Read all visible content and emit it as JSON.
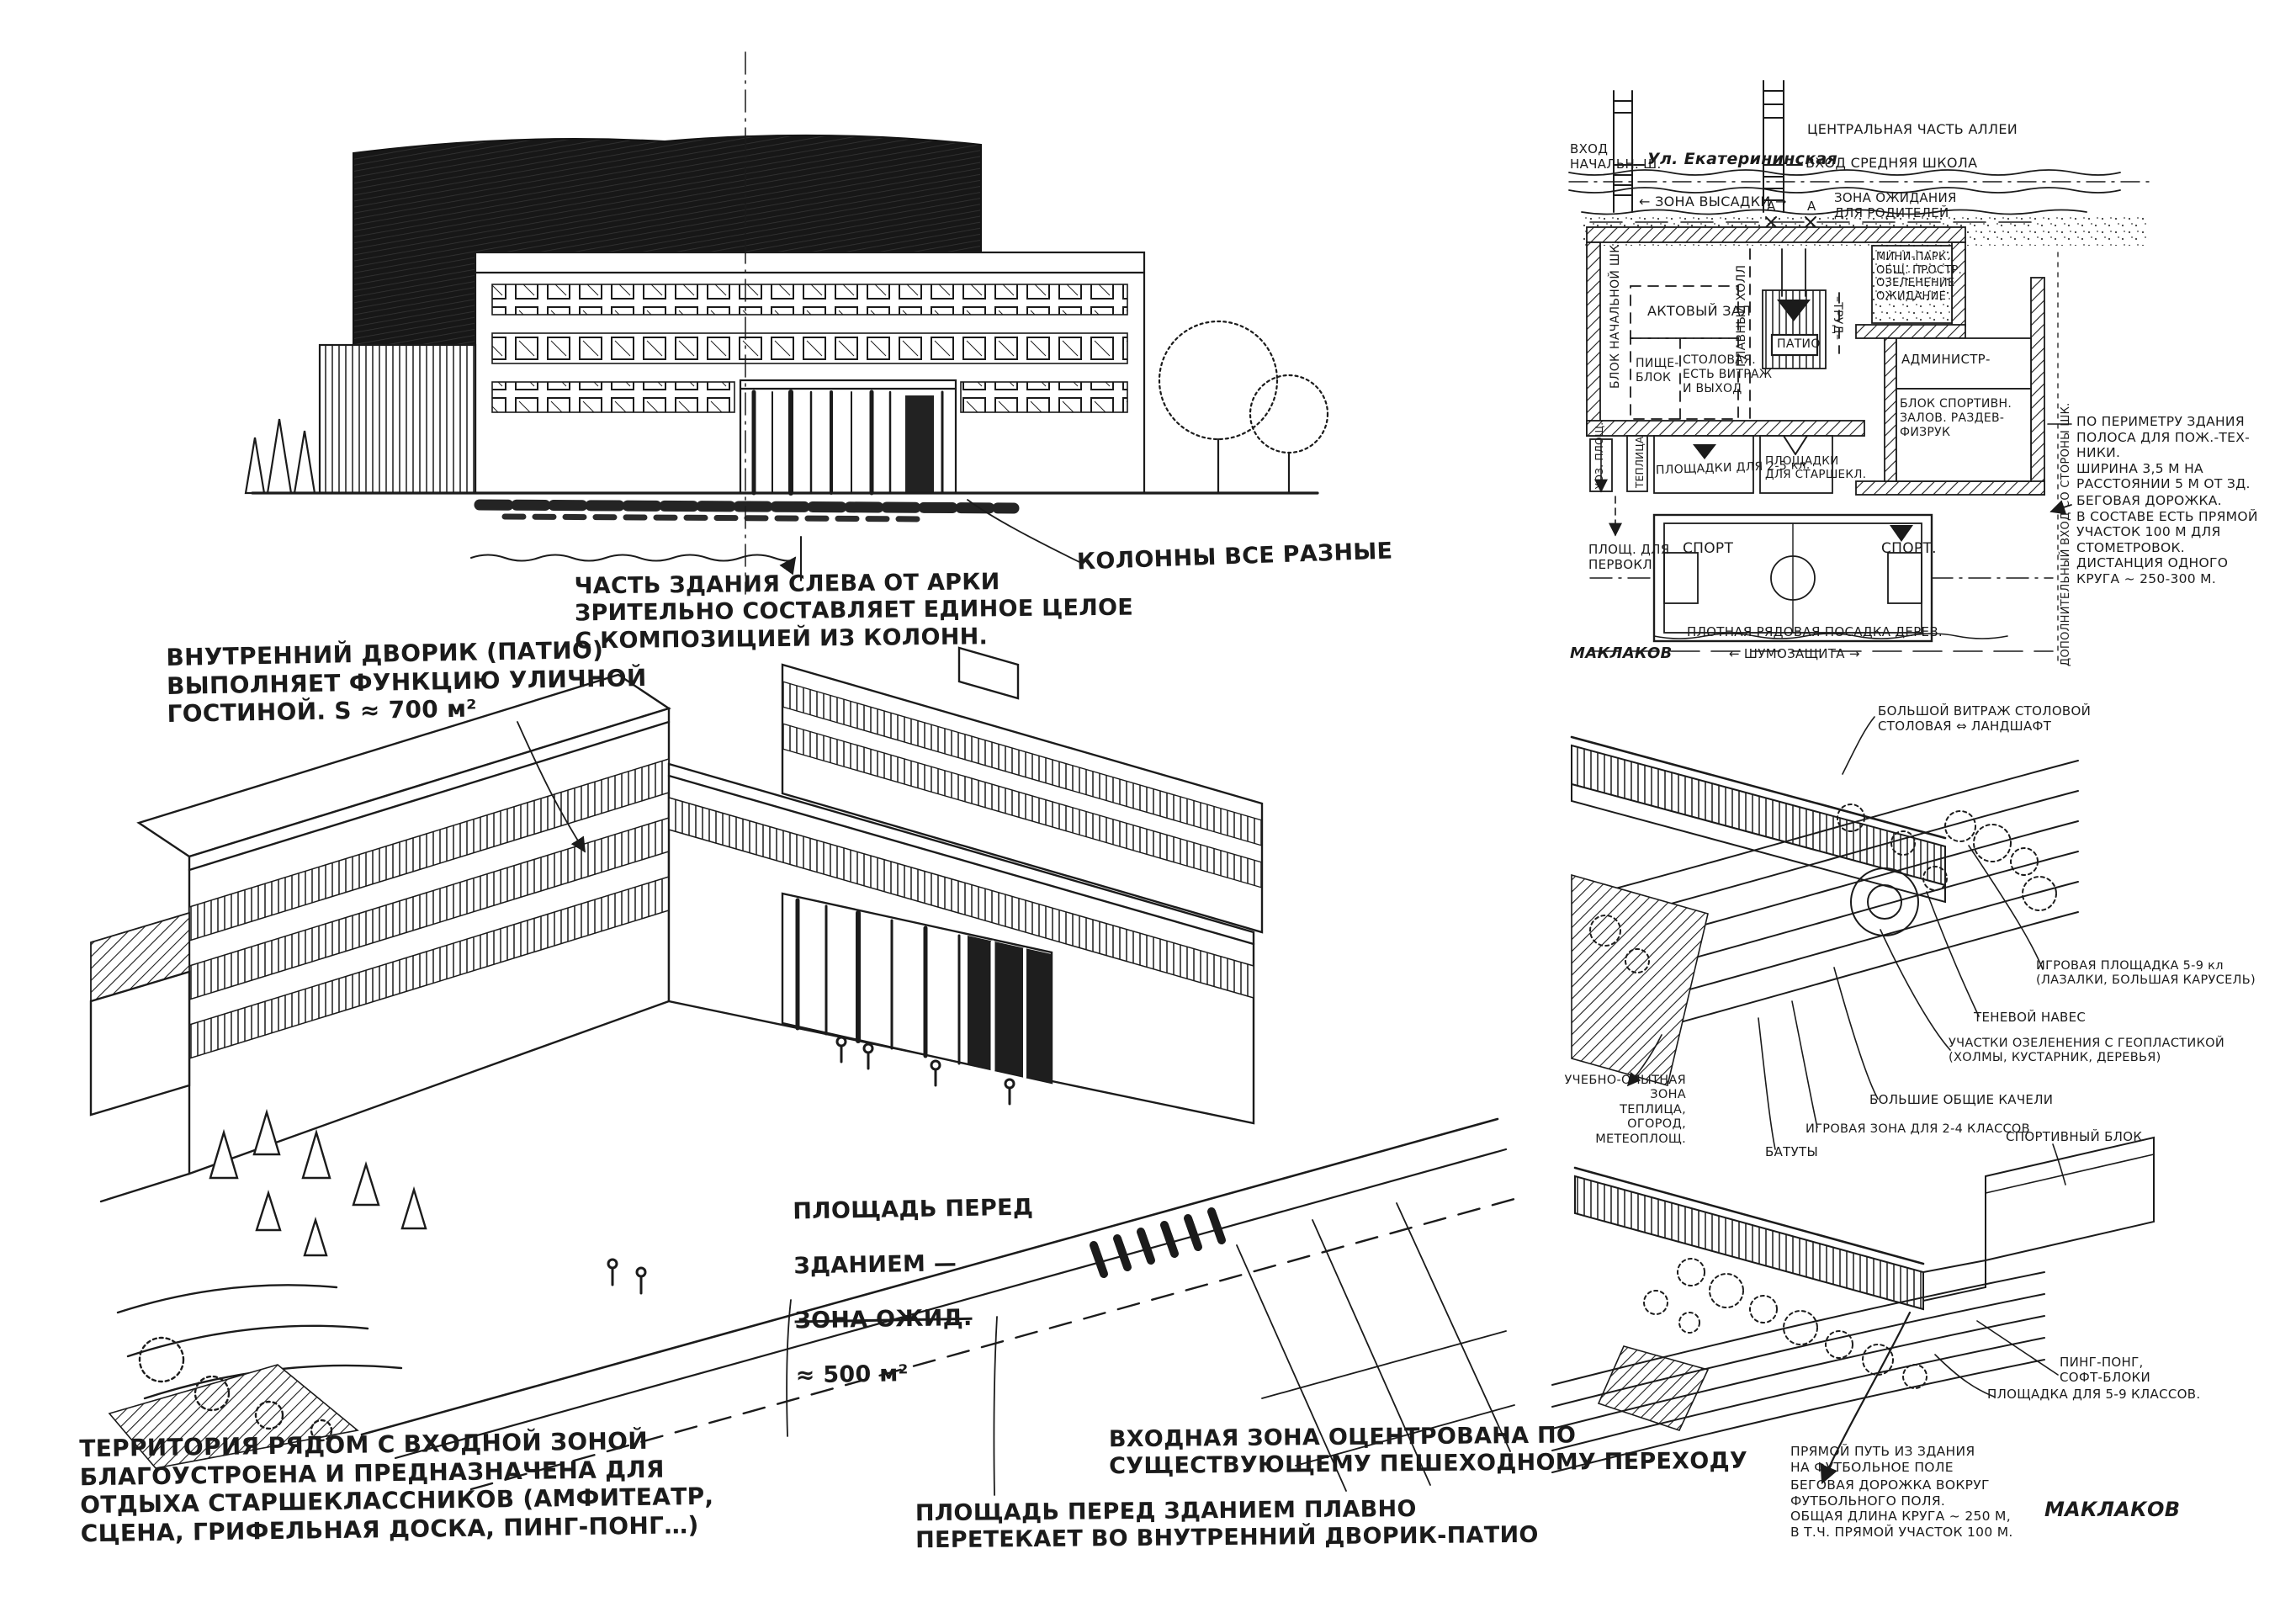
{
  "colors": {
    "ink": "#1b1b1b",
    "paper": "#ffffff"
  },
  "elevation_notes": {
    "composition": {
      "lines": [
        "ЧАСТЬ ЗДАНИЯ СЛЕВА ОТ АРКИ",
        "ЗРИТЕЛЬНО СОСТАВЛЯЕТ ЕДИНОЕ ЦЕЛОЕ",
        "С КОМПОЗИЦИЕЙ ИЗ КОЛОНН."
      ]
    },
    "columns": "КОЛОННЫ ВСЕ РАЗНЫЕ"
  },
  "axon_main_notes": {
    "patio": {
      "lines": [
        "ВНУТРЕННИЙ ДВОРИК (ПАТИО)",
        "ВЫПОЛНЯЕТ ФУНКЦИЮ УЛИЧНОЙ",
        "ГОСТИНОЙ.  S ≈ 700 м²"
      ]
    },
    "plaza": {
      "l1": "ПЛОЩАДЬ ПЕРЕД",
      "l2": "ЗДАНИЕМ —",
      "l3": "ЗОНА ОЖИД.",
      "l4": "≈ 500 м²"
    },
    "territory": {
      "lines": [
        "ТЕРРИТОРИЯ РЯДОМ С ВХОДНОЙ ЗОНОЙ",
        "БЛАГОУСТРОЕНА И ПРЕДНАЗНАЧЕНА ДЛЯ",
        "ОТДЫХА СТАРШЕКЛАССНИКОВ (АМФИТЕАТР,",
        "СЦЕНА, ГРИФЕЛЬНАЯ ДОСКА, ПИНГ-ПОНГ…)"
      ]
    },
    "entrance": {
      "lines": [
        "ВХОДНАЯ ЗОНА ОЦЕНТРОВАНА ПО",
        "СУЩЕСТВУЮЩЕМУ ПЕШЕХОДНОМУ ПЕРЕХОДУ"
      ]
    },
    "flow": {
      "lines": [
        "ПЛОЩАДЬ ПЕРЕД ЗДАНИЕМ ПЛАВНО",
        "ПЕРЕТЕКАЕТ ВО ВНУТРЕННИЙ ДВОРИК-ПАТИО"
      ]
    }
  },
  "site_plan": {
    "street_name": "Ул. Екатерининская",
    "alley": "ЦЕНТРАЛЬНАЯ ЧАСТЬ АЛЛЕИ",
    "entry_primary": {
      "lines": [
        "ВХОД",
        "НАЧАЛЬН. Ш."
      ]
    },
    "entry_secondary": "ВХОД СРЕДНЯЯ ШКОЛА",
    "dropoff_zone": "← ЗОНА ВЫСАДКИ →",
    "marker_a": "А",
    "waiting_zone": {
      "lines": [
        "ЗОНА ОЖИДАНИЯ",
        "ДЛЯ РОДИТЕЛЕЙ"
      ]
    },
    "mini_park": {
      "lines": [
        "МИНИ-ПАРК.",
        "ОБЩ. ПРОСТР.",
        "ОЗЕЛЕНЕНИЕ",
        "ОЖИДАНИЕ"
      ]
    },
    "primary_school_block": "БЛОК НАЧАЛЬНОЙ ШК.",
    "assembly_hall": "АКТОВЫЙ ЗАЛ",
    "food_block": {
      "lines": [
        "ПИЩЕ-",
        "БЛОК"
      ]
    },
    "canteen": {
      "lines": [
        "СТОЛОВАЯ.",
        "ЕСТЬ ВИТРАЖ",
        "И ВЫХОД"
      ]
    },
    "main_hall": "ГЛАВНЫЙ ХОЛЛ",
    "patio": "ПАТИО",
    "trud": "–ТРУД–",
    "admin": "АДМИНИСТР-",
    "sport_halls": {
      "lines": [
        "БЛОК СПОРТИВН.",
        "ЗАЛОВ. РАЗДЕВ-",
        "ФИЗРУК"
      ]
    },
    "hoz": "ХОЗ. ПЛОЩ.",
    "greenhouse": "ТЕПЛИЦА",
    "grounds_2_5": "ПЛОЩАДКИ ДЛЯ 2-5 кл.",
    "grounds_senior": {
      "lines": [
        "ПЛОЩАДКИ",
        "ДЛЯ СТАРШЕКЛ."
      ]
    },
    "grounds_first": {
      "lines": [
        "ПЛОЩ. ДЛЯ",
        "ПЕРВОКЛ."
      ]
    },
    "sport_left": "СПОРТ",
    "sport_right": "СПОРТ.",
    "tree_row": "ПЛОТНАЯ РЯДОВАЯ ПОСАДКА ДЕРЕВ.",
    "noise_shield": "←  ШУМОЗАЩИТА  →",
    "signature": "МАКЛАКОВ",
    "fire_lane_note": {
      "lines": [
        "ПО ПЕРИМЕТРУ ЗДАНИЯ",
        "ПОЛОСА ДЛЯ ПОЖ.-ТЕХ-",
        "НИКИ.",
        "ШИРИНА 3,5 М НА",
        "РАССТОЯНИИ 5 М ОТ ЗД."
      ]
    },
    "track_note": {
      "lines": [
        "БЕГОВАЯ ДОРОЖКА.",
        "В СОСТАВЕ ЕСТЬ ПРЯМОЙ",
        "УЧАСТОК 100 М ДЛЯ",
        "СТОМЕТРОВОК.",
        "ДИСТАНЦИЯ ОДНОГО",
        "КРУГА ~ 250-300 М."
      ]
    },
    "extra_entry": {
      "lines": [
        "ДОПОЛНИТЕЛЬНЫЙ ВХОД",
        "СО СТОРОНЫ ШК."
      ]
    }
  },
  "courtyard_axon": {
    "vitrage": {
      "lines": [
        "БОЛЬШОЙ ВИТРАЖ СТОЛОВОЙ",
        "СТОЛОВАЯ ⇔ ЛАНДШАФТ"
      ]
    },
    "playground_5_9": {
      "lines": [
        "ИГРОВАЯ ПЛОЩАДКА 5-9 кл",
        "(ЛАЗАЛКИ, БОЛЬШАЯ КАРУСЕЛЬ)"
      ]
    },
    "shade_canopy": "ТЕНЕВОЙ НАВЕС",
    "greenery": {
      "lines": [
        "УЧАСТКИ ОЗЕЛЕНЕНИЯ С ГЕОПЛАСТИКОЙ",
        "(ХОЛМЫ, КУСТАРНИК, ДЕРЕВЬЯ)"
      ]
    },
    "swings": "БОЛЬШИЕ ОБЩИЕ КАЧЕЛИ",
    "play_zone_2_4": "ИГРОВАЯ ЗОНА ДЛЯ 2-4 КЛАССОВ",
    "trampolines": "БАТУТЫ",
    "experimental_zone": {
      "lines": [
        "УЧЕБНО-ОПЫТНАЯ ЗОНА",
        "ТЕПЛИЦА,",
        "ОГОРОД,",
        "МЕТЕОПЛОЩ."
      ]
    }
  },
  "sport_axon": {
    "sport_block": "СПОРТИВНЫЙ БЛОК",
    "ping_pong": {
      "lines": [
        "ПИНГ-ПОНГ,",
        "СОФТ-БЛОКИ"
      ]
    },
    "grounds_5_9": "ПЛОЩАДКА ДЛЯ 5-9 КЛАССОВ.",
    "direct_path": {
      "lines": [
        "ПРЯМОЙ ПУТЬ ИЗ ЗДАНИЯ",
        "НА ФУТБОЛЬНОЕ ПОЛЕ"
      ]
    },
    "track_note": {
      "lines": [
        "БЕГОВАЯ ДОРОЖКА ВОКРУГ",
        "ФУТБОЛЬНОГО ПОЛЯ.",
        "ОБЩАЯ ДЛИНА КРУГА ~ 250 М,",
        "В Т.Ч. ПРЯМОЙ УЧАСТОК 100 М."
      ]
    },
    "signature": "МАКЛАКОВ"
  }
}
